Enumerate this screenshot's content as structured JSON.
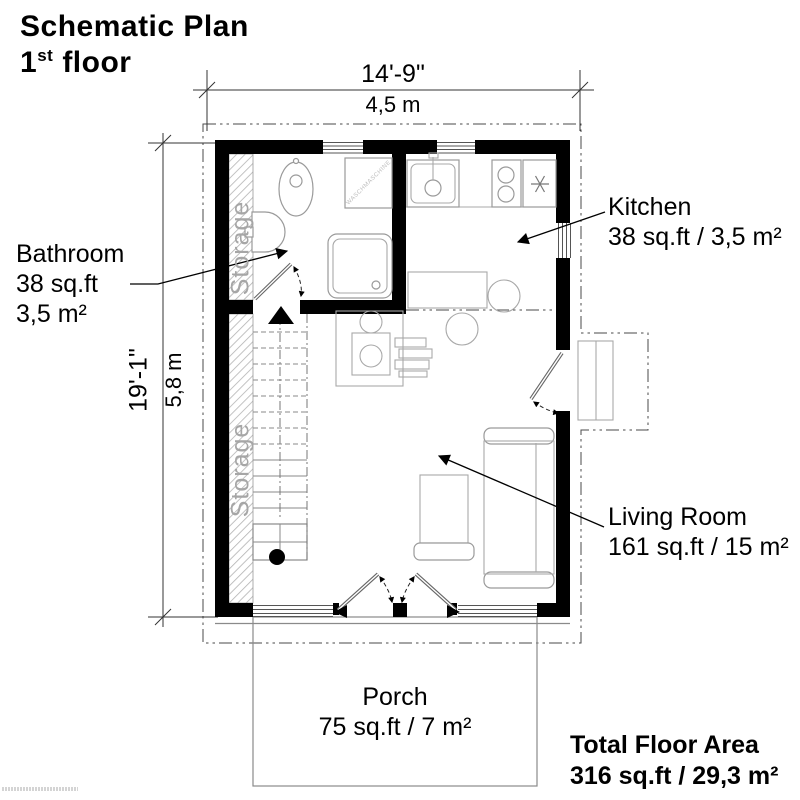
{
  "title": {
    "line1": "Schematic Plan",
    "floor_num": "1",
    "floor_sup": "st",
    "floor_rest": "floor"
  },
  "dimensions": {
    "top": {
      "imperial": "14'-9\"",
      "metric": "4,5 m"
    },
    "left": {
      "imperial": "19'-1\"",
      "metric": "5,8 m"
    }
  },
  "rooms": {
    "bathroom": {
      "name": "Bathroom",
      "area_ft": "38 sq.ft",
      "area_m": "3,5 m²"
    },
    "kitchen": {
      "name": "Kitchen",
      "area": "38 sq.ft / 3,5 m²"
    },
    "living_room": {
      "name": "Living Room",
      "area": "161 sq.ft / 15 m²"
    },
    "porch": {
      "name": "Porch",
      "area": "75 sq.ft / 7 m²"
    }
  },
  "storage_label": "Storage",
  "appliance_labels": {
    "washing_machine": "WASCHMASCHINE"
  },
  "total": {
    "label": "Total Floor Area",
    "value": "316 sq.ft / 29,3 m²"
  },
  "colors": {
    "wall": "#000000",
    "fixture_stroke": "#9a9a9a",
    "boundary": "#4a4a4a",
    "muted_text": "#a6a6a6"
  }
}
